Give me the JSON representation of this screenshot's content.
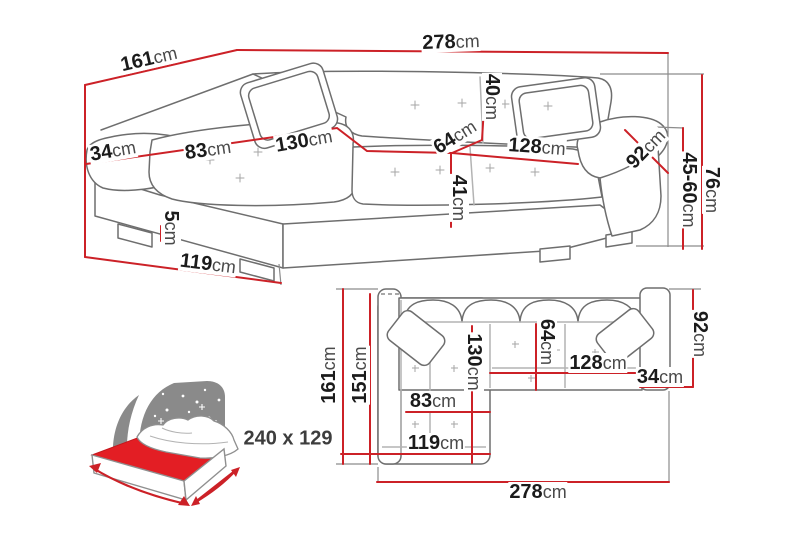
{
  "diagram_title": "corner-sofa-dimension-diagram",
  "colors": {
    "dimension_line": "#cc2127",
    "sketch_outline": "#6e6e6e",
    "extension_line": "#8c8c8c",
    "label_value_text": "#1b1b1b",
    "label_unit_text": "#4a4a4a",
    "bed_mattress": "#e31e24",
    "bed_headboard": "#8a8a8a"
  },
  "perspective_view": {
    "dimensions": {
      "total_width": {
        "value": "278",
        "unit": "cm"
      },
      "total_depth": {
        "value": "161",
        "unit": "cm"
      },
      "left_armrest_width": {
        "value": "34",
        "unit": "cm"
      },
      "chaise_seat_width": {
        "value": "83",
        "unit": "cm"
      },
      "chaise_length": {
        "value": "130",
        "unit": "cm"
      },
      "backrest_depth": {
        "value": "40",
        "unit": "cm"
      },
      "seat_depth": {
        "value": "64",
        "unit": "cm"
      },
      "right_seat_width": {
        "value": "128",
        "unit": "cm"
      },
      "right_armrest_length": {
        "value": "92",
        "unit": "cm"
      },
      "seat_height": {
        "value": "41",
        "unit": "cm"
      },
      "leg_height": {
        "value": "5",
        "unit": "cm"
      },
      "chaise_front_width": {
        "value": "119",
        "unit": "cm"
      },
      "armrest_height_range": {
        "value": "45-60",
        "unit": "cm"
      },
      "total_height": {
        "value": "76",
        "unit": "cm"
      }
    }
  },
  "plan_view": {
    "dimensions": {
      "total_depth": {
        "value": "161",
        "unit": "cm"
      },
      "chaise_inner_length": {
        "value": "151",
        "unit": "cm"
      },
      "chaise_length": {
        "value": "130",
        "unit": "cm"
      },
      "seat_depth": {
        "value": "64",
        "unit": "cm"
      },
      "right_seat_width": {
        "value": "128",
        "unit": "cm"
      },
      "right_armrest_width": {
        "value": "34",
        "unit": "cm"
      },
      "right_armrest_length": {
        "value": "92",
        "unit": "cm"
      },
      "chaise_seat_width": {
        "value": "83",
        "unit": "cm"
      },
      "chaise_front_width": {
        "value": "119",
        "unit": "cm"
      },
      "total_width": {
        "value": "278",
        "unit": "cm"
      }
    }
  },
  "sleeping_area": {
    "size_label": "240 x 129"
  }
}
